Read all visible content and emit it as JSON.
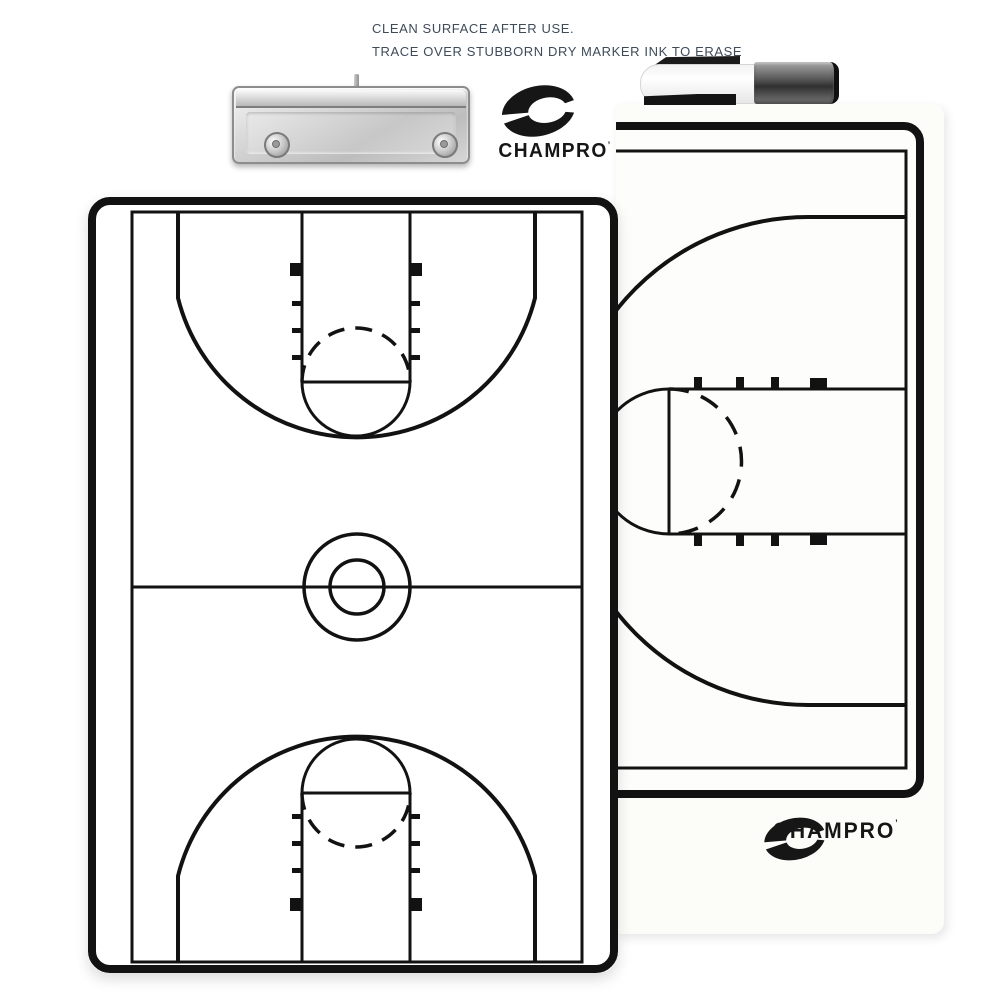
{
  "instructions": {
    "line1": "CLEAN SURFACE AFTER USE.",
    "line2": "TRACE OVER STUBBORN DRY MARKER INK TO ERASE",
    "text_color": "#3e4c5a"
  },
  "brand": {
    "wordmark": "CHAMPRO",
    "trademark_tick": "’",
    "logo_color": "#161616"
  },
  "boards": {
    "front": {
      "line_color": "#121212",
      "surface": "#ffffff"
    },
    "rear": {
      "line_color": "#121212",
      "surface": "#fdfdfb"
    }
  }
}
